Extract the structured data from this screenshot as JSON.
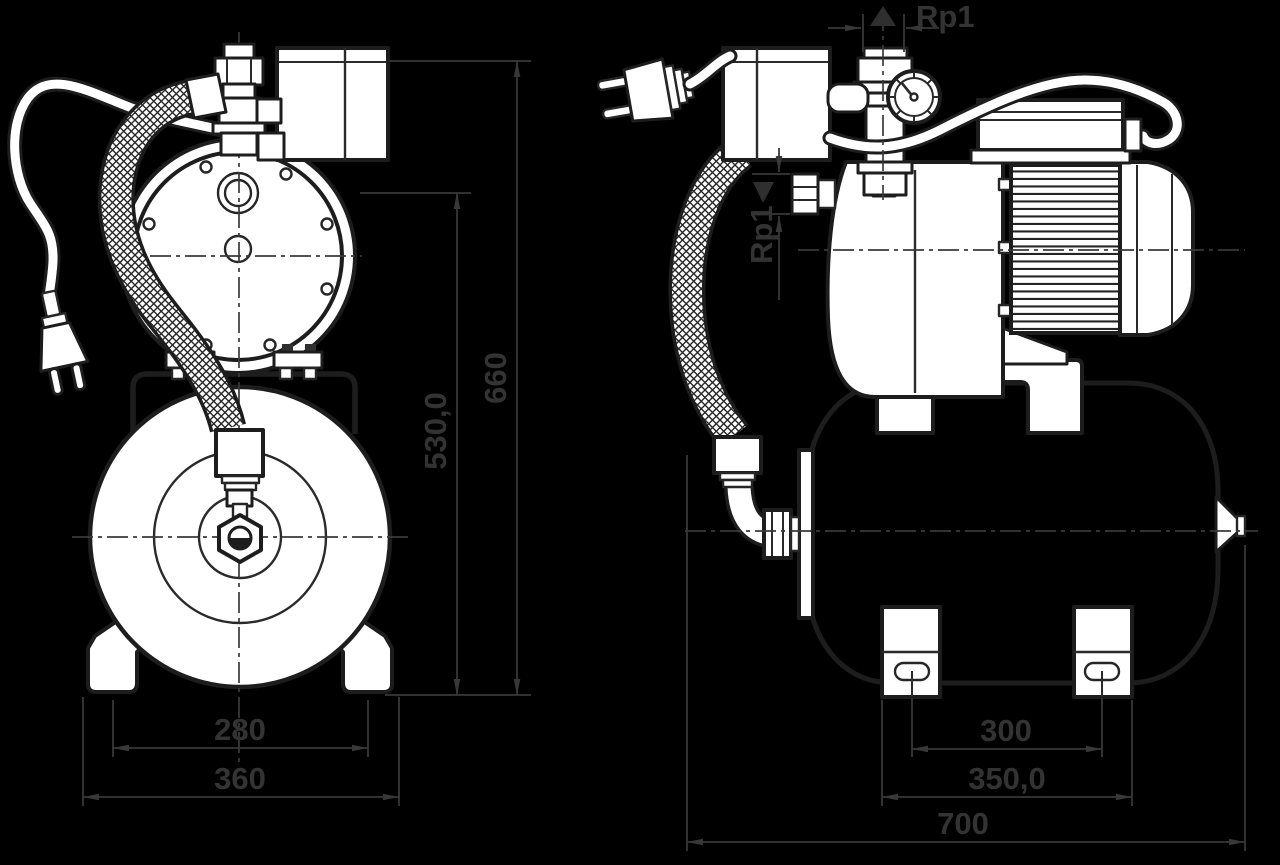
{
  "title": "Pump with pressure tank - dimension drawing (front and side view)",
  "colors": {
    "background": "#000000",
    "linework": "#343434",
    "part_fill": "#ffffff",
    "label_text": "#333333"
  },
  "views": {
    "front": {
      "dims": {
        "foot_centers": "280",
        "base_width": "360",
        "total_height": "660",
        "inlet_height": "530,0"
      }
    },
    "side": {
      "dims": {
        "discharge_port": "Rp1",
        "suction_port": "Rp1",
        "slot_centers": "300",
        "foot_span": "350,0",
        "total_length": "700"
      }
    }
  }
}
